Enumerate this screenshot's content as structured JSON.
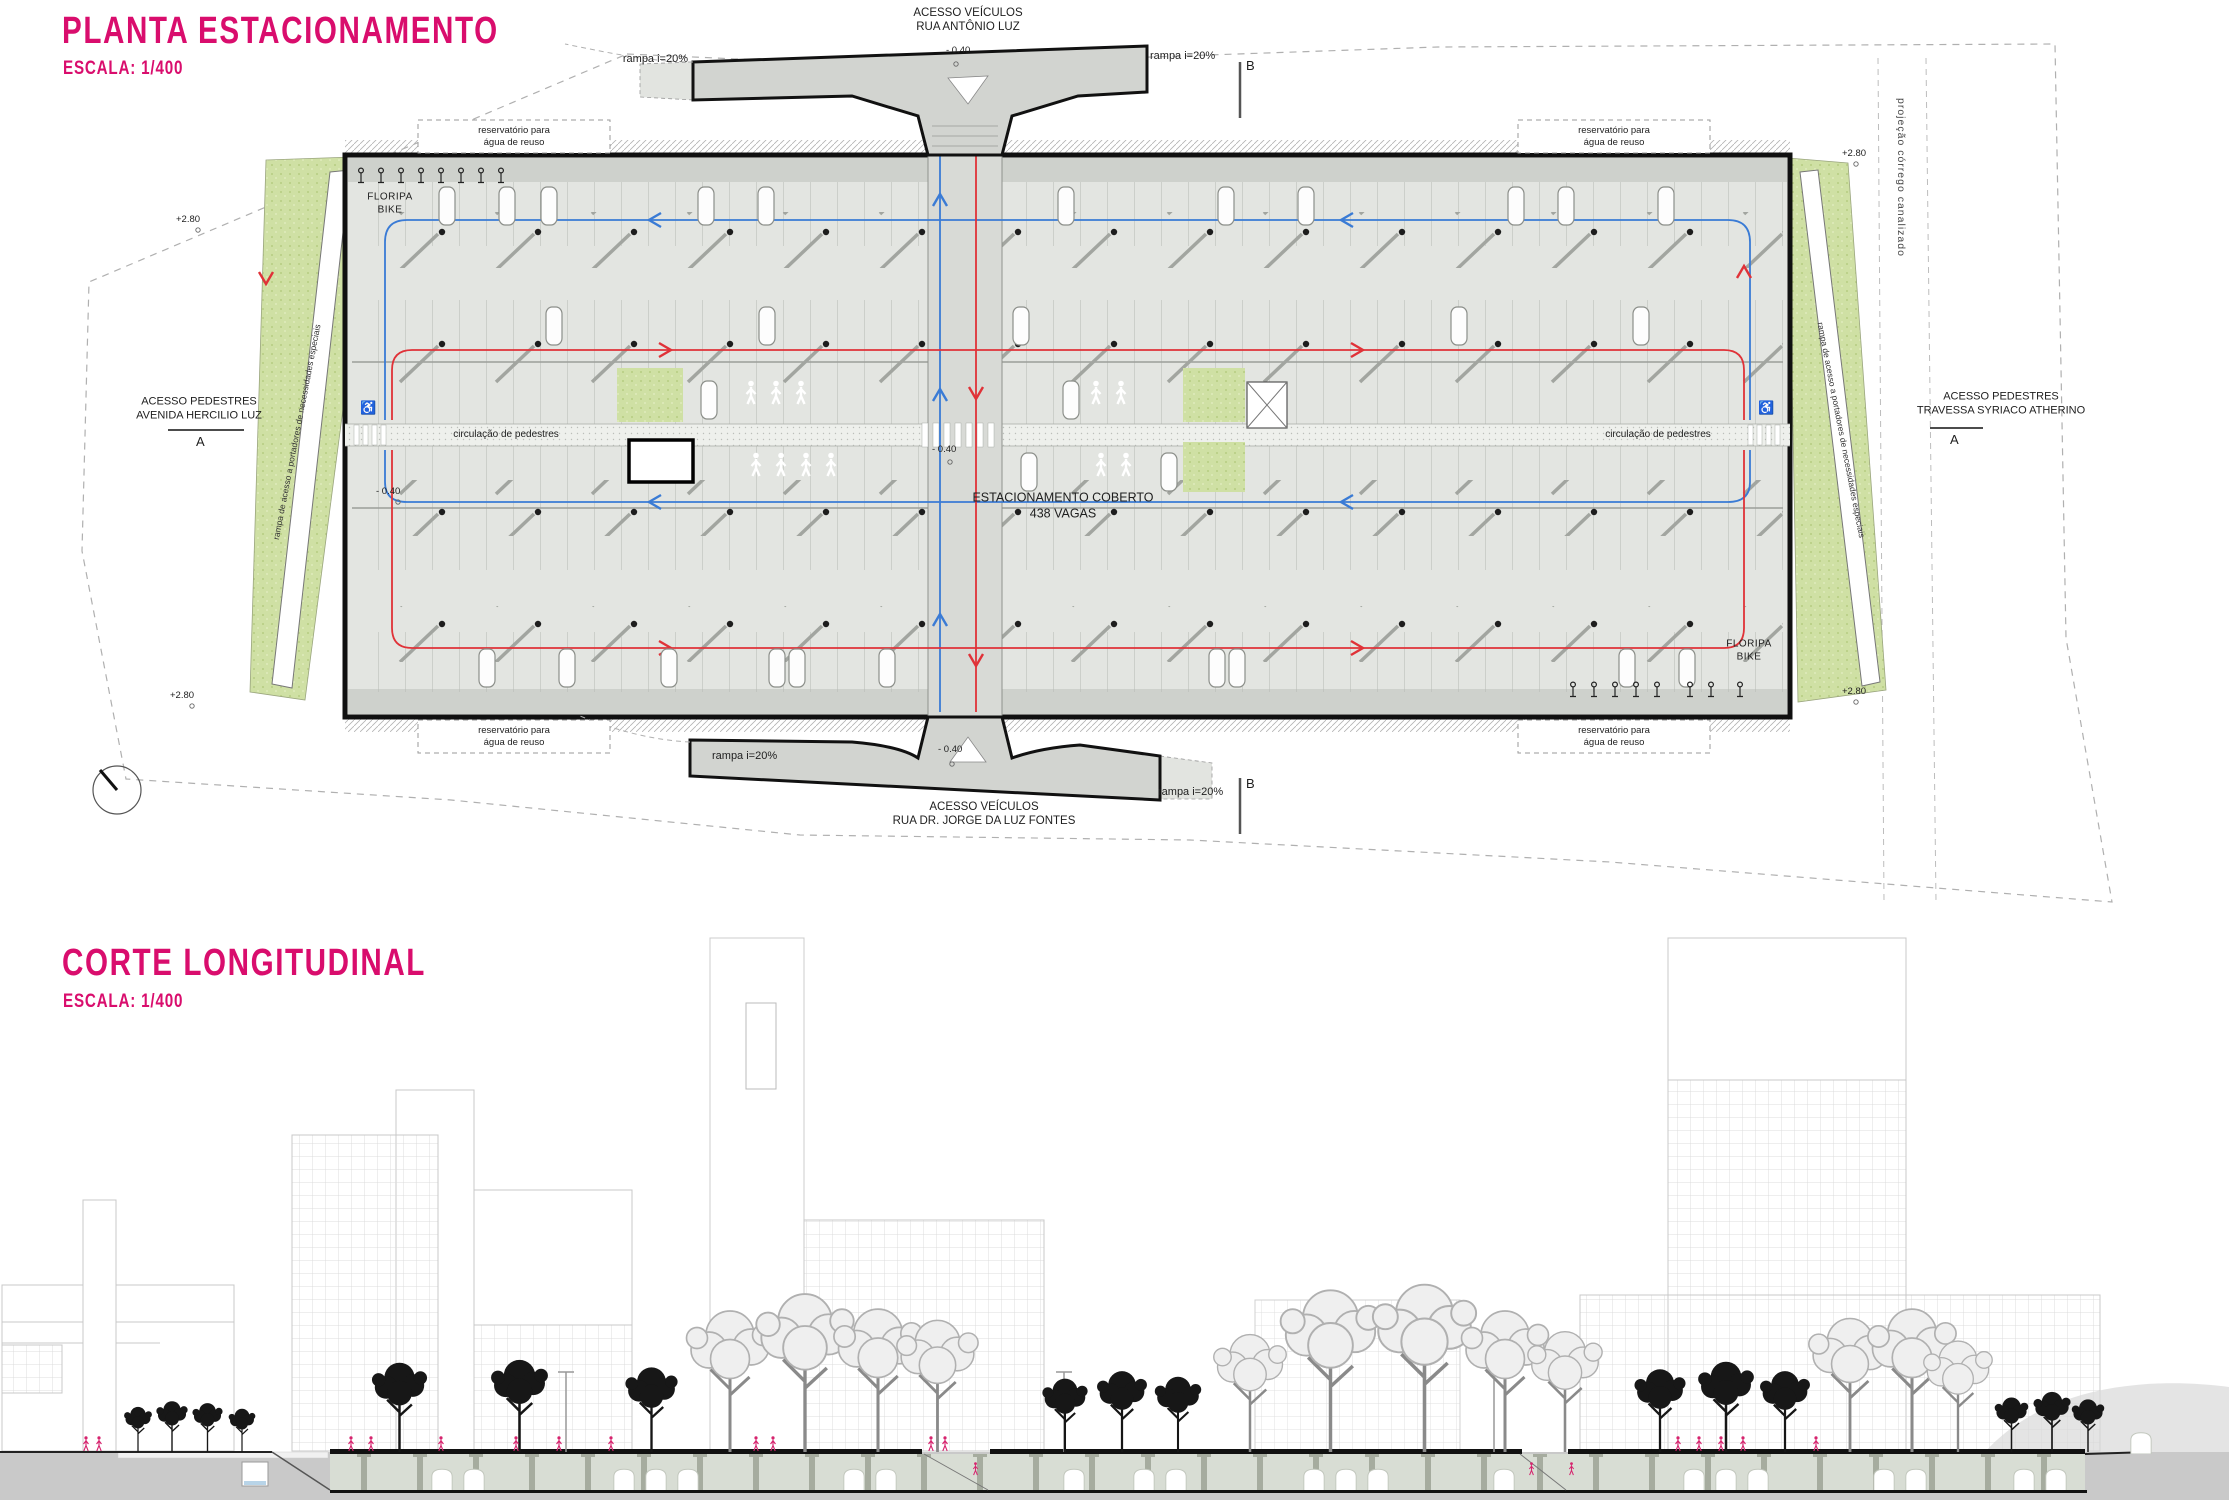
{
  "colors": {
    "accent-pink": "#d90d6d",
    "circulation-blue": "#3a7bd5",
    "circulation-red": "#e03238",
    "grass-green": "#cfe0a4",
    "figure-pink": "#d6246e",
    "ground-gray": "#c9c9c9"
  },
  "plan": {
    "title": "PLANTA ESTACIONAMENTO",
    "scale": "ESCALA: 1/400",
    "labels": {
      "access_top": [
        "ACESSO VEÍCULOS",
        "RUA ANTÔNIO LUZ"
      ],
      "access_bottom": [
        "ACESSO VEÍCULOS",
        "RUA DR. JORGE DA LUZ FONTES"
      ],
      "ped_left": [
        "ACESSO PEDESTRES",
        "AVENIDA HERCILIO LUZ"
      ],
      "ped_right": [
        "ACESSO PEDESTRES",
        "TRAVESSA SYRIACO ATHERINO"
      ],
      "reservoir": [
        "reservatório para",
        "água de reuso"
      ],
      "bike": [
        "FLORIPA",
        "BIKE"
      ],
      "covered": [
        "ESTACIONAMENTO COBERTO",
        "438 VAGAS"
      ],
      "ped_circulation": "circulação de pedestres",
      "ramp": "rampa i=20%",
      "stream": "projeção córrego canalizado",
      "accessible_ramp": "rampa de acesso a portadores de necessidades especiais",
      "marker_a": "A",
      "marker_b": "B",
      "elev_plus": "+2.80",
      "elev_minus": "- 0.40"
    },
    "icons": {
      "wheelchair": "♿"
    }
  },
  "section": {
    "title": "CORTE LONGITUDINAL",
    "scale": "ESCALA: 1/400"
  }
}
